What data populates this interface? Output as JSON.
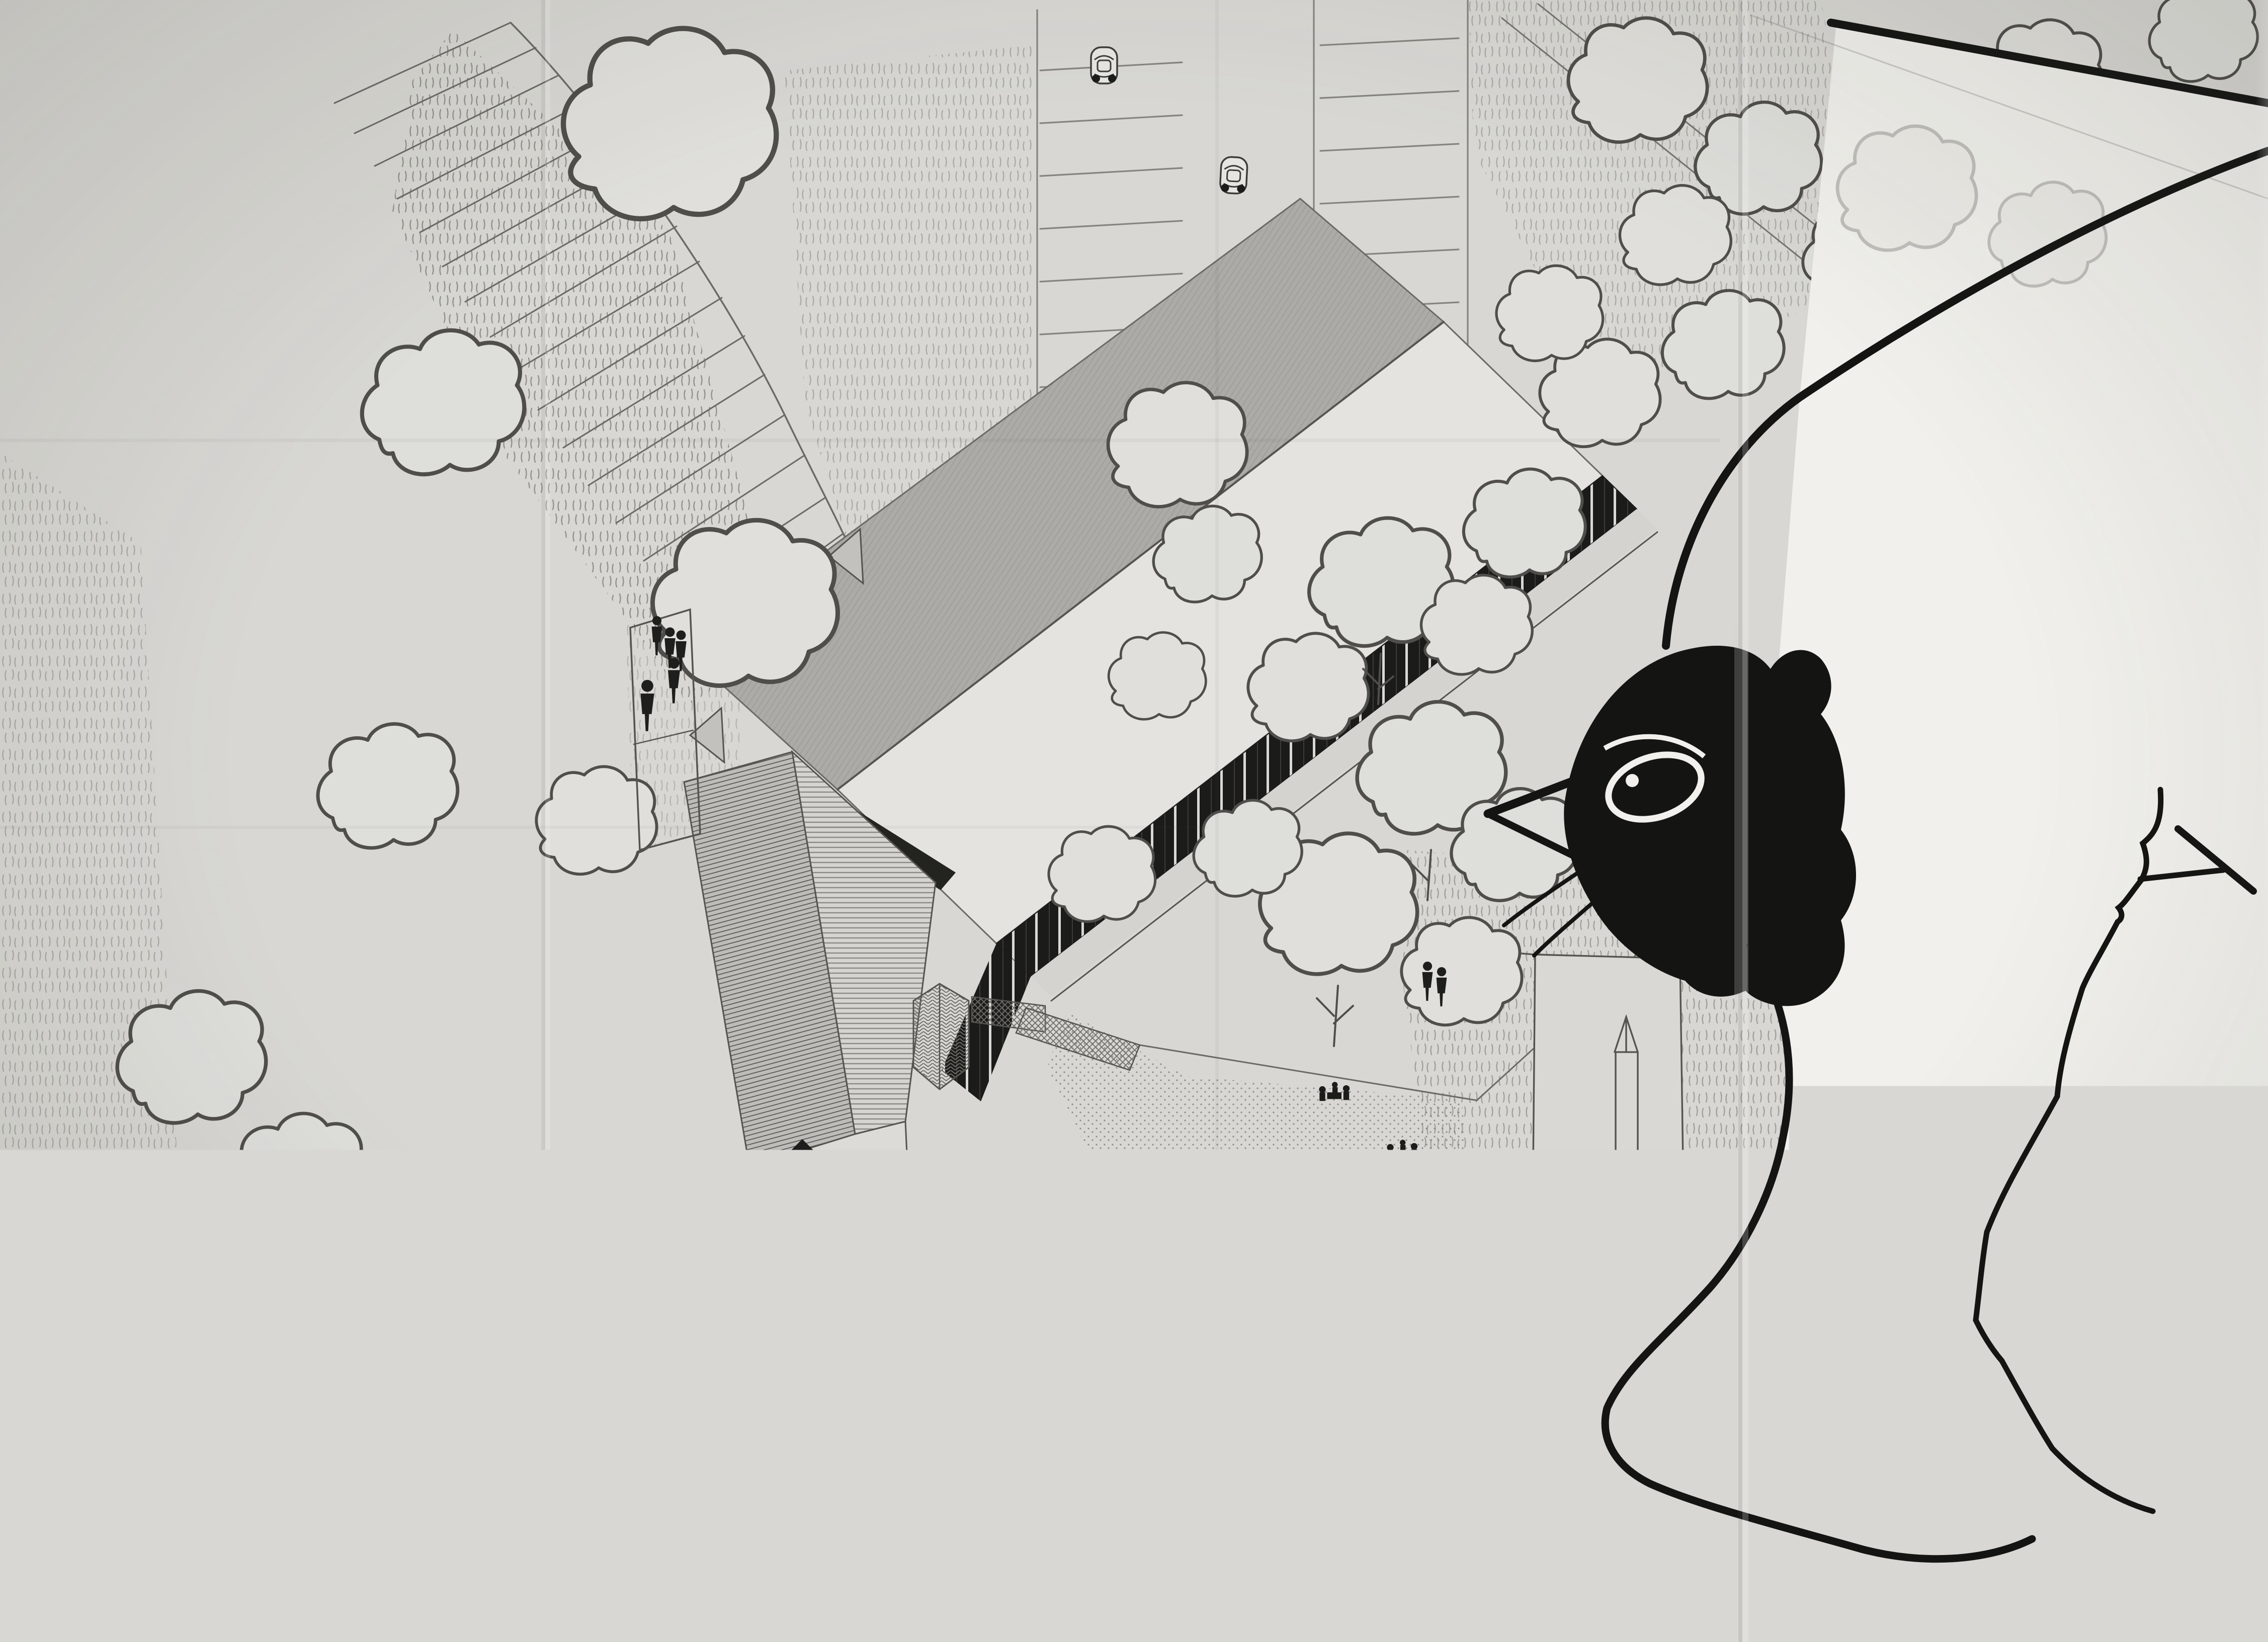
{
  "titleblock": {
    "permit_label": "PC",
    "permit_number": "143",
    "project_line1": "SIVU _ GYMNASE du LYCEE",
    "project_line2": "VICTOR  HUGO",
    "sheet_number": "3",
    "sheet_title": "AXONOMETRIE",
    "date": "OCTOBRE 87",
    "scale": "échelle 1/200",
    "revisions": [
      "A",
      "B",
      "C",
      "D"
    ],
    "architect": "p. pincemaille  architecte   3 rue pasteur  56100 LORIENT  tel 97.64.10.98"
  },
  "annotations": {
    "signature": "pp 87"
  },
  "drawing": {
    "colors": {
      "paper": "#d8d7d3",
      "ink": "#55544f",
      "roof_gray": "#acaba7",
      "glazing_black": "#1b1b19",
      "bird_ink": "#141412",
      "bird_white": "#f1f0ec"
    }
  }
}
